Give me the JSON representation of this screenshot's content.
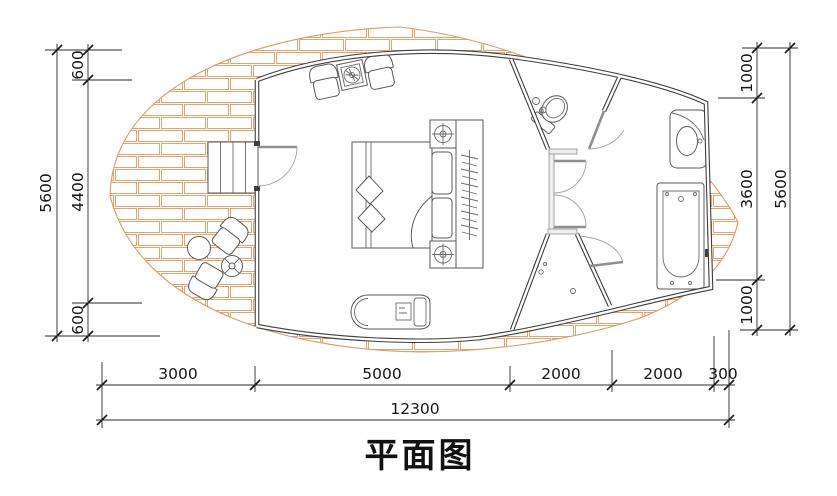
{
  "title": "平面图",
  "dimensions": {
    "left": {
      "total": "5600",
      "segments": [
        "600",
        "4400",
        "600"
      ]
    },
    "right": {
      "total": "5600",
      "segments": [
        "1000",
        "3600",
        "1000"
      ]
    },
    "bottom": {
      "total": "12300",
      "segments": [
        "3000",
        "5000",
        "2000",
        "2000",
        "300"
      ]
    }
  },
  "colors": {
    "background": "#ffffff",
    "wall": "#3e3e3e",
    "furniture_line": "#5a5a5a",
    "door_leaf": "#8f8f8f",
    "brick_joint": "#e5a370",
    "dimension_line": "#2a2a2a",
    "text": "#161616"
  },
  "symbols": [
    "brick-paved-terrace",
    "entry-steps",
    "entry-door",
    "armchair",
    "side-table",
    "double-bed",
    "nightstand-lamp",
    "bedside-bench",
    "wardrobe-with-hangers",
    "chaise-lounge",
    "outdoor-round-table",
    "outdoor-stool",
    "outdoor-chair",
    "toilet",
    "corridor-doors",
    "shower-enclosure",
    "shower-door",
    "washbasin-vanity",
    "bathtub"
  ]
}
